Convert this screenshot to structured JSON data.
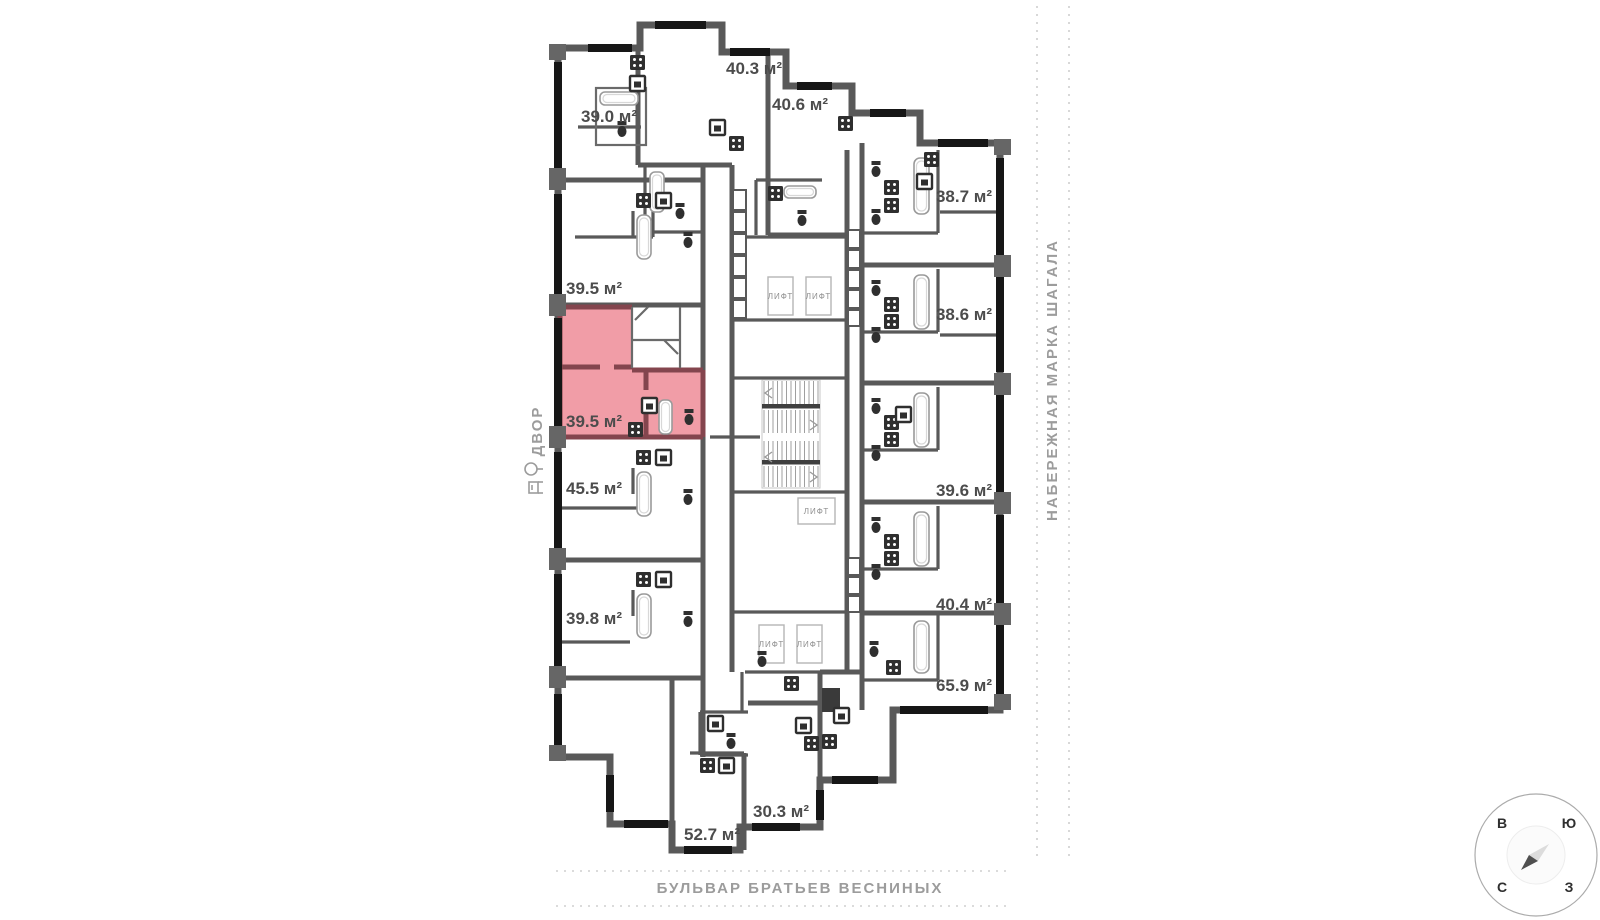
{
  "palette": {
    "wall": "#595959",
    "window": "#161616",
    "highlight_fill": "#f19da7",
    "highlight_wall": "#84454e",
    "label_text": "#4c4c4c",
    "muted_text": "#9c9c9c"
  },
  "apartments": [
    {
      "label": "40.3 м²",
      "highlighted": false
    },
    {
      "label": "40.6 м²",
      "highlighted": false
    },
    {
      "label": "39.0 м²",
      "highlighted": false
    },
    {
      "label": "38.7 м²",
      "highlighted": false
    },
    {
      "label": "39.5 м²",
      "highlighted": false
    },
    {
      "label": "38.6 м²",
      "highlighted": false
    },
    {
      "label": "39.5 м²",
      "highlighted": true
    },
    {
      "label": "45.5 м²",
      "highlighted": false
    },
    {
      "label": "39.6 м²",
      "highlighted": false
    },
    {
      "label": "39.8 м²",
      "highlighted": false
    },
    {
      "label": "40.4 м²",
      "highlighted": false
    },
    {
      "label": "65.9 м²",
      "highlighted": false
    },
    {
      "label": "30.3 м²",
      "highlighted": false
    },
    {
      "label": "52.7 м²",
      "highlighted": false
    }
  ],
  "labels": {
    "elevator": "ЛИФТ"
  },
  "streets": {
    "bottom": "БУЛЬВАР БРАТЬЕВ ВЕСНИНЫХ",
    "right": "НАБЕРЕЖНАЯ МАРКА ШАГАЛА",
    "courtyard": "ДВОР"
  },
  "compass": {
    "top_left": "В",
    "top_right": "Ю",
    "bottom_left": "С",
    "bottom_right": "З"
  }
}
